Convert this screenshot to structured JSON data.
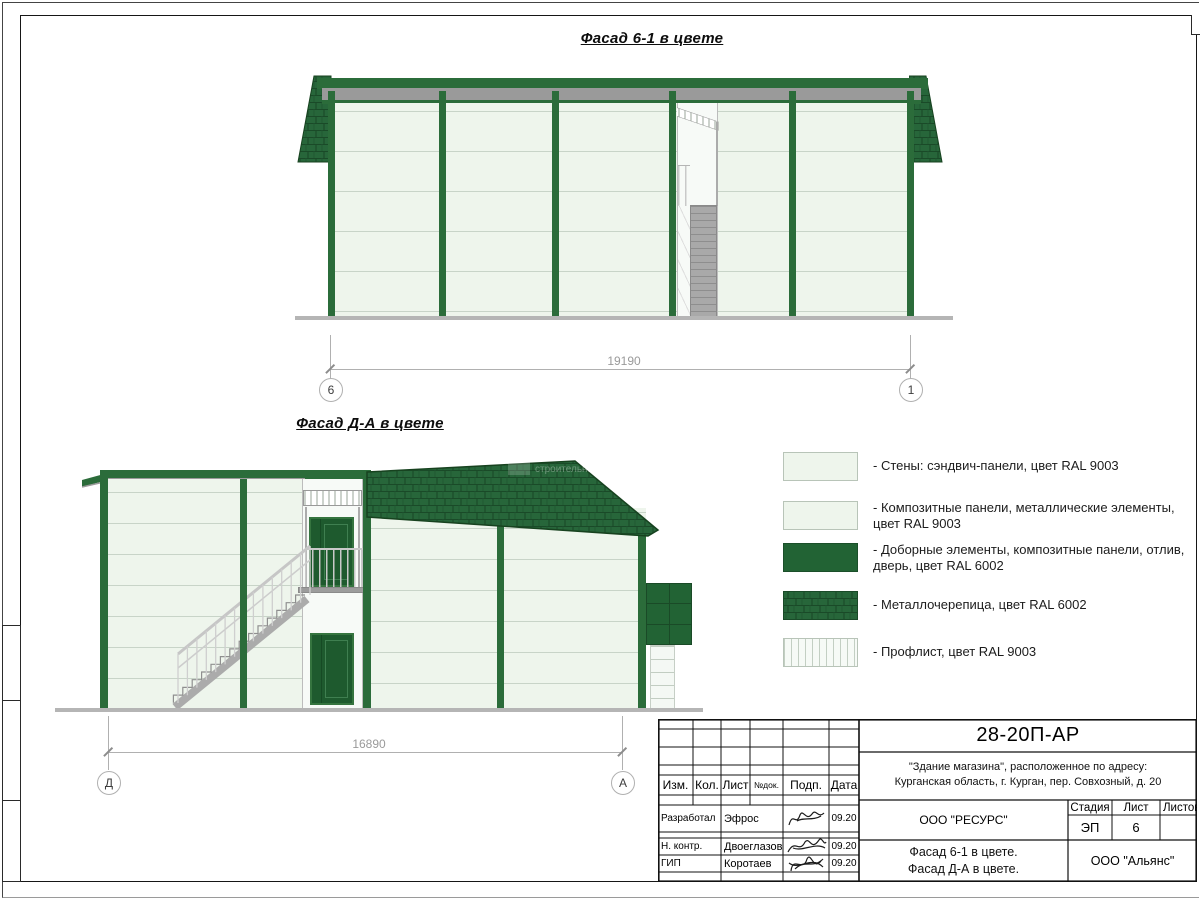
{
  "page": {
    "bg": "#ffffff"
  },
  "facade_6_1": {
    "title": "Фасад 6-1 в цвете",
    "dimension": "19190",
    "axis_left": "6",
    "axis_right": "1"
  },
  "facade_d_a": {
    "title": "Фасад Д-А в цвете",
    "dimension": "16890",
    "axis_left": "Д",
    "axis_right": "А",
    "watermark": "строительная"
  },
  "legend": {
    "items": [
      {
        "swatch": "wall-light",
        "label": "- Стены: сэндвич-панели, цвет RAL 9003"
      },
      {
        "swatch": "wall-light",
        "label": "- Композитные панели, металлические элементы, цвет RAL 9003"
      },
      {
        "swatch": "solid-green",
        "label": "- Доборные элементы,  композитные панели, отлив, дверь, цвет RAL 6002"
      },
      {
        "swatch": "metal-tile",
        "label": "- Металлочерепица, цвет RAL 6002"
      },
      {
        "swatch": "profiled-sheet",
        "label": "- Профлист, цвет RAL 9003"
      }
    ]
  },
  "colors": {
    "ral9003_panel": "#eef5ec",
    "ral6002_frame": "#2b6c3a",
    "ral6002_roof": "#27663a",
    "gray_metal": "#9a9a9a"
  },
  "title_block": {
    "code": "28-20П-АР",
    "object_address_line1": "\"Здание магазина\", расположенное по адресу:",
    "object_address_line2": "Курганская область, г. Курган, пер. Совхозный, д. 20",
    "columns": [
      "Изм.",
      "Кол.",
      "Лист",
      "№док.",
      "Подп.",
      "Дата"
    ],
    "signature_rows": [
      {
        "role": "Разработал",
        "name": "Эфрос",
        "date": "09.20"
      },
      {
        "role": "Н. контр.",
        "name": "Двоеглазов",
        "date": "09.20"
      },
      {
        "role": "ГИП",
        "name": "Коротаев",
        "date": "09.20"
      }
    ],
    "designer_org": "ООО \"РЕСУРС\"",
    "sheet_title_line1": "Фасад 6-1 в цвете.",
    "sheet_title_line2": "Фасад Д-А в цвете.",
    "stage_label": "Стадия",
    "sheet_label": "Лист",
    "sheets_label": "Листов",
    "stage_value": "ЭП",
    "sheet_value": "6",
    "sheets_value": "",
    "customer_org": "ООО \"Альянс\""
  }
}
